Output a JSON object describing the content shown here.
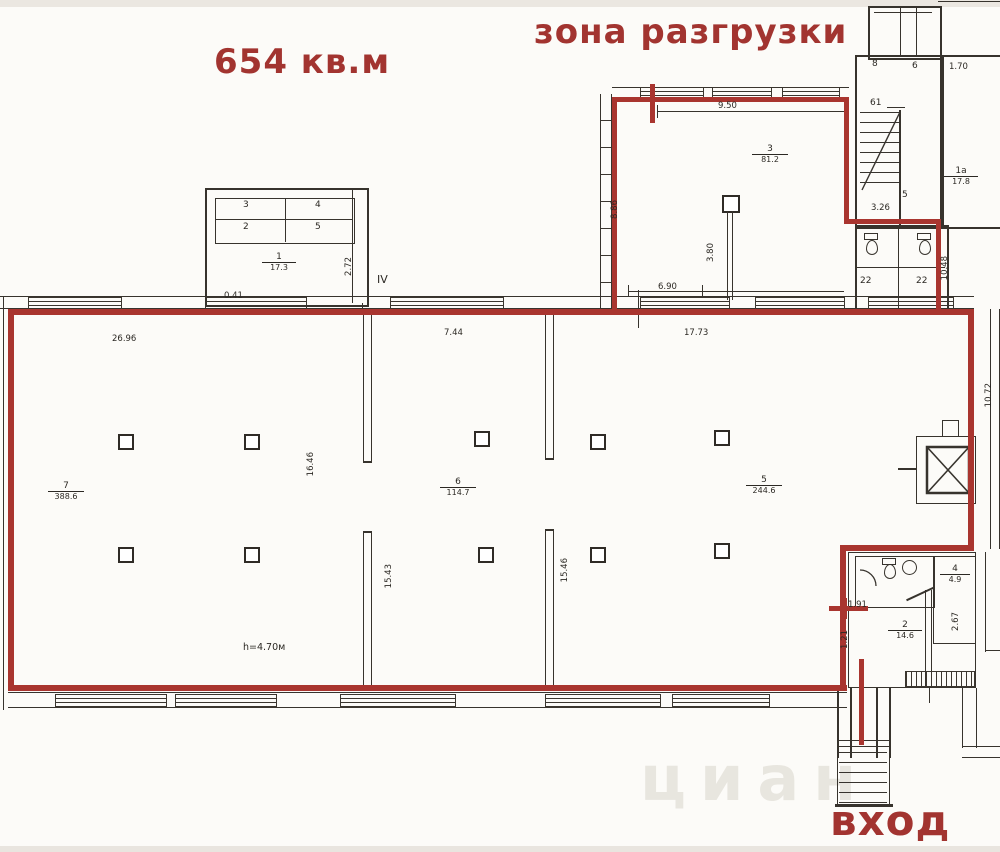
{
  "titles": {
    "area": "654 кв.м",
    "unloading": "зона разгрузки",
    "entrance": "вход",
    "watermark": "циан"
  },
  "rooms": {
    "hall_left": {
      "num": "7",
      "area": "388.6"
    },
    "hall_mid": {
      "num": "6",
      "area": "114.7"
    },
    "hall_right": {
      "num": "5",
      "area": "244.6"
    },
    "unloading": {
      "num": "3",
      "area": "81.2"
    },
    "storeroom": {
      "num": "1",
      "area": "17.3"
    },
    "stair_room": {
      "num": "1а",
      "area": "17.8"
    },
    "wc": {
      "num": "4",
      "area": "4.9"
    },
    "vestibule": {
      "num": "2",
      "area": "14.6"
    },
    "cells": {
      "a": "3",
      "b": "4",
      "c": "2",
      "d": "5",
      "e": "22",
      "f": "22"
    },
    "stair_marks": {
      "a": "8",
      "b": "6",
      "c": "61",
      "d": "5"
    }
  },
  "dims": {
    "hall_top": "26.96",
    "seg_a": "7.44",
    "seg_b": "17.73",
    "seg_c": "6.90",
    "unloading_top": "9.50",
    "block_a": "0.41",
    "block_b": "2.72",
    "axis": "IV",
    "stair_a": "1.70",
    "stair_b": "3.26",
    "unloading_left": "8.86",
    "unloading_col": "3.80",
    "cells_right": "10.48",
    "part_top": "16.46",
    "part_left": "15.43",
    "part_right": "15.46",
    "height_note": "h=4.70м",
    "door_a": "1.91",
    "door_b": "1.21",
    "room_c": "2.67",
    "right_wall": "10.72"
  }
}
